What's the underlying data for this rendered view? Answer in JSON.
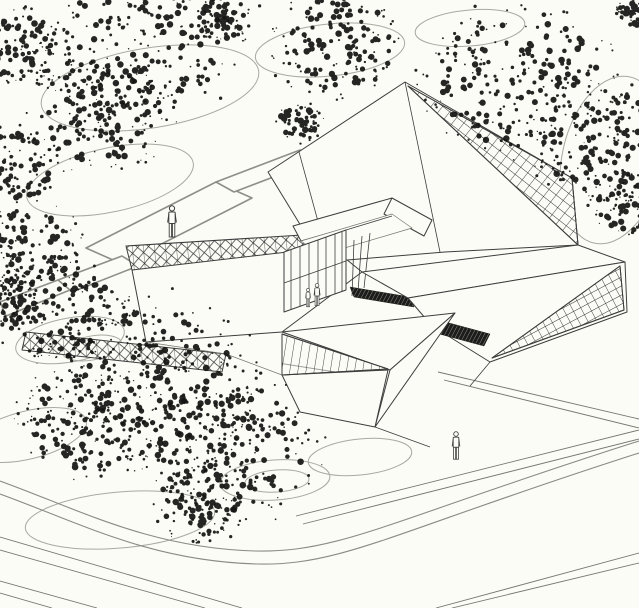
{
  "meta": {
    "description": "Black and white axonometric architectural site drawing: faceted pavilion building with two diagrid glass roof planes, a glazed courtyard, truss curtain-wall bands, dark louver strips, scribbled tree canopies, looping ground contours, paved plaza paths, a curved road and pedestrian figures"
  },
  "palette": {
    "background": "#fcfcf7",
    "paper": "#fcfcf7",
    "line": "#3d3d3d",
    "line_soft": "#77776f",
    "grid": "#2f2f2f",
    "contour": "#a9a9a1",
    "road": "#8b8b85",
    "path_edge": "#8f8f88",
    "foliage": "#151513",
    "louver_dark": "#1c1c1a"
  },
  "scene": {
    "trees": [
      {
        "x": 142,
        "y": 42,
        "r": 80
      },
      {
        "x": 100,
        "y": 112,
        "r": 60
      },
      {
        "x": 22,
        "y": 48,
        "r": 38
      },
      {
        "x": 12,
        "y": 168,
        "r": 42
      },
      {
        "x": 26,
        "y": 248,
        "r": 46
      },
      {
        "x": 62,
        "y": 312,
        "r": 55
      },
      {
        "x": 338,
        "y": 44,
        "r": 56
      },
      {
        "x": 228,
        "y": 16,
        "r": 26
      },
      {
        "x": 518,
        "y": 78,
        "r": 80
      },
      {
        "x": 604,
        "y": 142,
        "r": 62
      },
      {
        "x": 628,
        "y": 205,
        "r": 30
      },
      {
        "x": 150,
        "y": 378,
        "r": 88
      },
      {
        "x": 228,
        "y": 446,
        "r": 76
      },
      {
        "x": 86,
        "y": 420,
        "r": 58
      },
      {
        "x": 200,
        "y": 502,
        "r": 40
      },
      {
        "x": 0,
        "y": 300,
        "r": 30
      },
      {
        "x": 298,
        "y": 122,
        "r": 20
      },
      {
        "x": 632,
        "y": 14,
        "r": 14
      }
    ],
    "figures": [
      {
        "x": 172,
        "y": 239,
        "h": 34
      },
      {
        "x": 456,
        "y": 461,
        "h": 30
      },
      {
        "x": 317,
        "y": 307,
        "h": 24
      },
      {
        "x": 308,
        "y": 308,
        "h": 20
      }
    ],
    "contours": [
      {
        "cx": 150,
        "cy": 88,
        "rx": 110,
        "ry": 40,
        "rot": -9
      },
      {
        "cx": 110,
        "cy": 180,
        "rx": 85,
        "ry": 32,
        "rot": -12
      },
      {
        "cx": 330,
        "cy": 50,
        "rx": 75,
        "ry": 26,
        "rot": -6
      },
      {
        "cx": 470,
        "cy": 28,
        "rx": 55,
        "ry": 18,
        "rot": -5
      },
      {
        "cx": 612,
        "cy": 160,
        "rx": 50,
        "ry": 85,
        "rot": 12
      },
      {
        "cx": 70,
        "cy": 340,
        "rx": 55,
        "ry": 22,
        "rot": -10
      },
      {
        "cx": 92,
        "cy": 348,
        "rx": 30,
        "ry": 12,
        "rot": -10
      },
      {
        "cx": 275,
        "cy": 480,
        "rx": 55,
        "ry": 20,
        "rot": -4
      },
      {
        "cx": 277,
        "cy": 481,
        "rx": 32,
        "ry": 11,
        "rot": -4
      },
      {
        "cx": 360,
        "cy": 457,
        "rx": 52,
        "ry": 18,
        "rot": -6
      },
      {
        "cx": 120,
        "cy": 520,
        "rx": 95,
        "ry": 28,
        "rot": -5
      },
      {
        "cx": 28,
        "cy": 435,
        "rx": 60,
        "ry": 24,
        "rot": -14
      }
    ]
  }
}
